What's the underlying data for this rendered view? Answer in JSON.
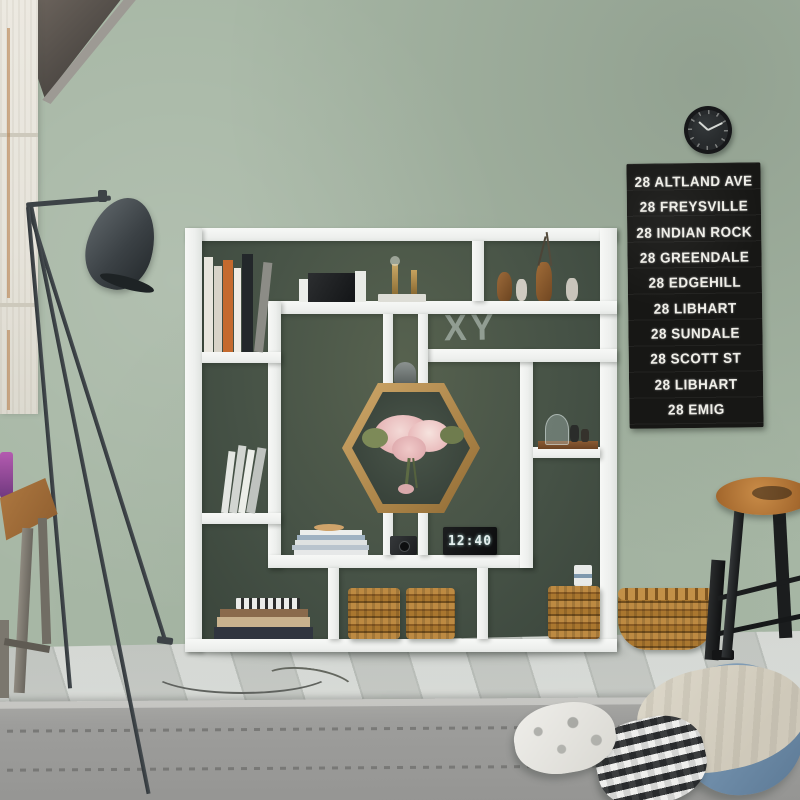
{
  "chalkboard": {
    "lines": [
      "28 ALTLAND AVE",
      "28 FREYSVILLE",
      "28 INDIAN ROCK",
      "28 GREENDALE",
      "28 EDGEHILL",
      "28 LIBHART",
      "28 SUNDALE",
      "28 SCOTT ST",
      "28 LIBHART",
      "28 EMIG"
    ]
  },
  "wall_decor": {
    "letters": "XY"
  },
  "digital_clock": {
    "time": "12:40"
  },
  "colors": {
    "wall": "#a7b7a5",
    "accent_wall": "#465246",
    "shelf": "#f1f3f1",
    "chalkboard_bg": "#171715",
    "chalk_text": "#f0efe9",
    "wicker": "#a7732e",
    "floor": "#cdd1cd",
    "rug": "#9d9d9b",
    "lamp": "#3d4347",
    "stool_wood": "#b0763a",
    "pillow_blue": "#7e99b2"
  }
}
